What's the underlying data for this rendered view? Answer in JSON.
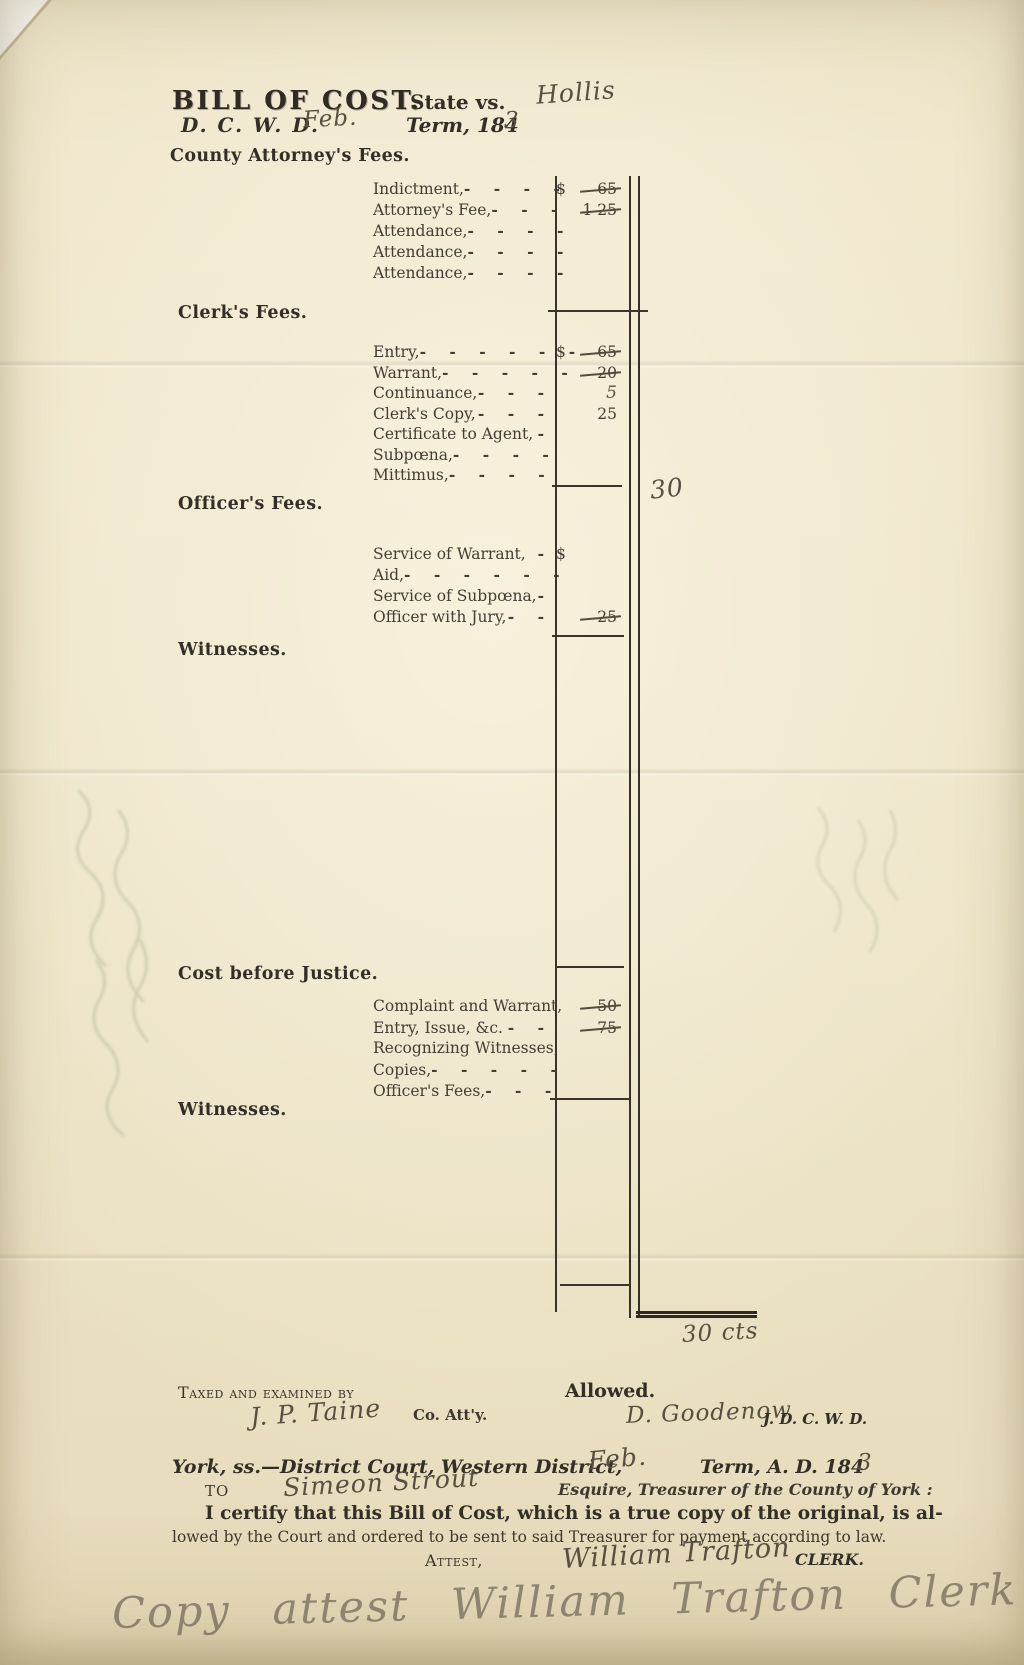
{
  "header": {
    "title": "BILL OF COST.",
    "state_vs": "State vs.",
    "defendant": "Hollis",
    "court_abbr": "D. C. W. D.",
    "term_month": "Feb.",
    "term_prefix": "Term, 184",
    "term_year": "3"
  },
  "sections": {
    "county_attorney": {
      "heading": "County Attorney's Fees.",
      "rows": [
        {
          "label": "Indictment,",
          "dashes": "- - - -",
          "dollar": "$",
          "amount": "65"
        },
        {
          "label": "Attorney's Fee,",
          "dashes": "- - -",
          "amount": "1 25"
        },
        {
          "label": "Attendance,",
          "dashes": "- - - -"
        },
        {
          "label": "Attendance,",
          "dashes": "- - - -"
        },
        {
          "label": "Attendance,",
          "dashes": "- - - -"
        }
      ]
    },
    "clerk": {
      "heading": "Clerk's Fees.",
      "rows": [
        {
          "label": "Entry,",
          "dashes": "- - - - - -",
          "dollar": "$",
          "amount": "65"
        },
        {
          "label": "Warrant,",
          "dashes": "- - - - -",
          "amount": "20"
        },
        {
          "label": "Continuance,",
          "dashes": "- - -",
          "amount": "5"
        },
        {
          "label": "Clerk's Copy,",
          "dashes": "- - -",
          "amount": "25"
        },
        {
          "label": "Certificate to Agent,",
          "dashes": "-"
        },
        {
          "label": "Subpœna,",
          "dashes": "- - - -"
        },
        {
          "label": "Mittimus,",
          "dashes": "- - - -"
        }
      ]
    },
    "officer": {
      "heading": "Officer's Fees.",
      "margin_note": "30",
      "rows": [
        {
          "label": "Service of Warrant,",
          "dashes": "-",
          "dollar": "$"
        },
        {
          "label": "Aid,",
          "dashes": "- - - - - -"
        },
        {
          "label": "Service of Subpœna,",
          "dashes": "-"
        },
        {
          "label": "Officer with Jury,",
          "dashes": "- -",
          "amount": "25"
        }
      ]
    },
    "witnesses_1": {
      "heading": "Witnesses."
    },
    "cost_before_justice": {
      "heading": "Cost before Justice.",
      "rows": [
        {
          "label": "Complaint and Warrant,",
          "amount": "50"
        },
        {
          "label": "Entry, Issue, &c.",
          "dashes": "- -",
          "amount": "75"
        },
        {
          "label": "Recognizing Witnesses,"
        },
        {
          "label": "Copies,",
          "dashes": "- - - - -"
        },
        {
          "label": "Officer's Fees,",
          "dashes": "- - -"
        }
      ]
    },
    "witnesses_2": {
      "heading": "Witnesses."
    },
    "total_note": "30 cts"
  },
  "signoff": {
    "taxed_label": "Taxed and examined by",
    "taxed_signature": "J. P. Taine",
    "co_attorney_label": "Co. Att'y.",
    "allowed_label": "Allowed.",
    "allowed_signature": "D. Goodenow",
    "judge_abbr": "J. D. C. W. D."
  },
  "certification": {
    "court_line": "York, ss.—District Court, Western District,",
    "term_month": "Feb.",
    "term_prefix": "Term, A. D. 184",
    "term_year": "3",
    "to_label": "TO",
    "treasurer_name": "Simeon Strout",
    "treasurer_title": "Esquire, Treasurer of the County of York :",
    "certify_line_1": "I certify that this Bill of Cost, which is a true copy of the original, is al-",
    "certify_line_2": "lowed by the Court and ordered to be sent to said Treasurer for payment according to law.",
    "attest_label": "Attest,",
    "clerk_signature": "William Trafton",
    "clerk_label": "CLERK."
  },
  "footer": {
    "copy_note": "Copy attest  William Trafton  Clerk"
  }
}
